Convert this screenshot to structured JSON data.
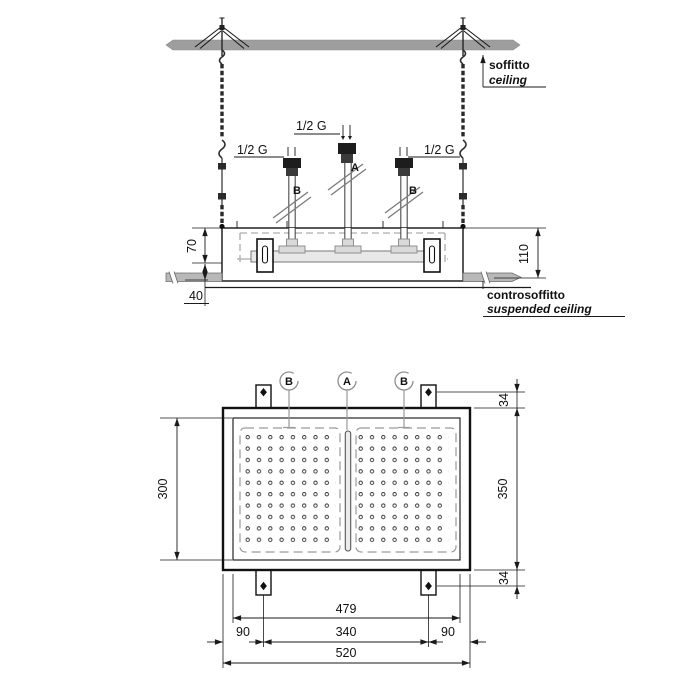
{
  "side_view": {
    "ceiling_label_it": "soffitto",
    "ceiling_label_en": "ceiling",
    "suspended_ceiling_label_it": "controsoffitto",
    "suspended_ceiling_label_en": "suspended ceiling",
    "inlet_center": "1/2 G",
    "inlet_left": "1/2 G",
    "inlet_right": "1/2 G",
    "outlet_a": "A",
    "outlet_b_left": "B",
    "outlet_b_right": "B",
    "dim_recess_depth": "70",
    "dim_total_depth": "110",
    "dim_ceiling_gap": "40"
  },
  "plan_view": {
    "callout_a": "A",
    "callout_b_left": "B",
    "callout_b_right": "B",
    "dim_inner_height": "300",
    "dim_panel_height": "350",
    "dim_tab_top": "34",
    "dim_tab_bottom": "34",
    "dim_inner_width": "479",
    "dim_left_margin": "90",
    "dim_tab_spacing": "340",
    "dim_right_margin": "90",
    "dim_panel_width": "520",
    "nozzle_grid": {
      "zones": 2,
      "columns_per_zone": 8,
      "rows_per_zone": 10
    }
  },
  "colors": {
    "ink": "#1a1a1a",
    "slab_gray": "#9e9e9e",
    "ceiling_bar_gray": "#b8b8b8",
    "hidden_line_gray": "#9a9a9a",
    "metal_gray": "#d9d9d9"
  }
}
